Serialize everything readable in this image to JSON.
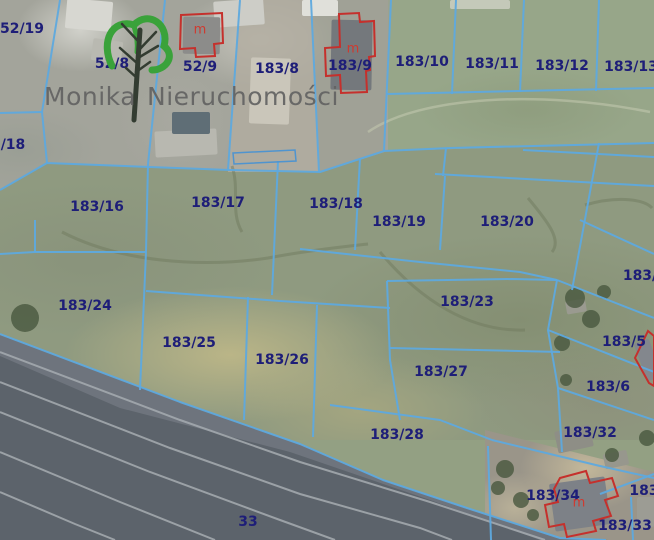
{
  "logo": {
    "word1": "Monika",
    "word2": "Nieruchomości"
  },
  "map": {
    "colors": {
      "boundary": "#5ea9de",
      "building_outline": "#c5302c",
      "label": "#1e1e78",
      "label_red": "#cf3a30",
      "railway_fill": "#5c636b",
      "railway_inner": "#7d848c",
      "railway_stripe": "#a6abb0",
      "track_dark": "#6f7a5e",
      "track_light": "#c5cbb0",
      "tree_fill": "#48583f",
      "shed_outline": "#4f94cf"
    },
    "parcel_labels": [
      {
        "text": "52/19",
        "x": 22,
        "y": 29
      },
      {
        "text": "52/8",
        "x": 112,
        "y": 64
      },
      {
        "text": "52/9",
        "x": 200,
        "y": 67
      },
      {
        "text": "183/8",
        "x": 277,
        "y": 69
      },
      {
        "text": "183/9",
        "x": 350,
        "y": 66
      },
      {
        "text": "183/10",
        "x": 422,
        "y": 62
      },
      {
        "text": "183/11",
        "x": 492,
        "y": 64
      },
      {
        "text": "183/12",
        "x": 562,
        "y": 66
      },
      {
        "text": "183/13",
        "x": 631,
        "y": 67
      },
      {
        "text": "/18",
        "x": 13,
        "y": 145
      },
      {
        "text": "183/16",
        "x": 97,
        "y": 207
      },
      {
        "text": "183/17",
        "x": 218,
        "y": 203
      },
      {
        "text": "183/18",
        "x": 336,
        "y": 204
      },
      {
        "text": "183/19",
        "x": 399,
        "y": 222
      },
      {
        "text": "183/20",
        "x": 507,
        "y": 222
      },
      {
        "text": "183/",
        "x": 640,
        "y": 276
      },
      {
        "text": "183/24",
        "x": 85,
        "y": 306
      },
      {
        "text": "183/23",
        "x": 467,
        "y": 302
      },
      {
        "text": "183/25",
        "x": 189,
        "y": 343
      },
      {
        "text": "183/26",
        "x": 282,
        "y": 360
      },
      {
        "text": "183/5",
        "x": 624,
        "y": 342
      },
      {
        "text": "183/27",
        "x": 441,
        "y": 372
      },
      {
        "text": "183/6",
        "x": 608,
        "y": 387
      },
      {
        "text": "183/32",
        "x": 590,
        "y": 433
      },
      {
        "text": "183/28",
        "x": 397,
        "y": 435
      },
      {
        "text": "183/34",
        "x": 553,
        "y": 496
      },
      {
        "text": "183",
        "x": 644,
        "y": 491
      },
      {
        "text": "183/33",
        "x": 625,
        "y": 526
      },
      {
        "text": "33",
        "x": 248,
        "y": 522
      }
    ],
    "building_marks": [
      {
        "text": "m",
        "x": 200,
        "y": 30
      },
      {
        "text": "m",
        "x": 353,
        "y": 49
      },
      {
        "text": "m",
        "x": 579,
        "y": 503
      }
    ],
    "buildings": [
      {
        "id": "building-52-9",
        "points": "181,15 222,13 223,43 214,44 215,56 196,57 195,48 180,49"
      },
      {
        "id": "building-183-9",
        "points": "339,14 359,13 360,22 374,21 375,56 369,57 370,70 366,71 367,92 341,93 340,75 326,76 325,48 340,47"
      },
      {
        "id": "building-183-5",
        "points": "648,331 654,336 654,386 649,383 635,358"
      },
      {
        "id": "building-183-34",
        "points": "560,478 586,471 590,483 612,478 618,496 605,500 611,516 593,521 596,531 567,537 564,524 549,527 545,505 558,502 554,489"
      }
    ],
    "shed_outline": "233,153 295,150 296,161 234,164",
    "boundary_lines": [
      "60,0 42,112",
      "165,0 148,164",
      "240,0 228,170",
      "311,0 319,172",
      "391,0 384,151",
      "456,0 452,94",
      "524,0 520,92",
      "599,0 596,91",
      "0,113 42,112",
      "42,112 47,163",
      "0,190 47,163 150,167 230,170 320,172 384,151",
      "384,151 450,148 654,143",
      "387,94 654,88",
      "523,150 654,157",
      "435,174 654,186",
      "446,148 443,176",
      "148,164 146,252 140,390",
      "278,161 272,295",
      "360,158 355,250",
      "445,176 440,250",
      "599,143 572,290",
      "300,249 420,262 520,272 557,280",
      "387,281 512,279 557,280",
      "35,220 35,252",
      "0,254 35,252 146,252",
      "146,291 280,301 390,308",
      "248,297 244,420",
      "317,305 313,437",
      "387,281 390,360 400,420",
      "390,348 560,352",
      "580,220 654,254",
      "557,280 654,318",
      "548,330 654,372",
      "558,388 654,420",
      "557,280 548,330 558,388 562,452",
      "330,405 440,420 492,440",
      "492,440 600,466 654,478",
      "600,494 654,474",
      "488,446 491,540",
      "631,497 633,540",
      "0,334 180,402 300,444 383,480 467,508 560,538 606,540"
    ],
    "railway": {
      "area": "0,334 180,402 300,444 383,480 467,508 560,538 608,540 0,540",
      "inner": "0,334 180,402 300,444 383,480 467,508 560,538 600,540 540,540 430,500 290,452 120,408 0,356",
      "stripes": [
        "0,352 180,420 300,462 430,502 545,540",
        "0,382 170,448 300,494 420,528 452,540",
        "0,412 150,472 280,520 335,540",
        "0,452 120,502 215,540",
        "0,492 75,524 115,540"
      ]
    },
    "tracks_dark": [
      "M62,232 C120,262 200,268 268,258 C310,250 350,246 368,244",
      "M380,252 C420,300 470,332 525,330",
      "M528,198 C548,222 562,240 552,252",
      "M232,166 C240,190 230,212 242,232",
      "M585,205 C620,195 645,200 652,208"
    ],
    "tracks_light": [
      "M368,132 C420,96 540,90 650,112"
    ],
    "trees": [
      [
        575,
        298,
        10
      ],
      [
        591,
        319,
        9
      ],
      [
        562,
        343,
        8
      ],
      [
        604,
        292,
        7
      ],
      [
        505,
        469,
        9
      ],
      [
        521,
        500,
        8
      ],
      [
        612,
        455,
        7
      ],
      [
        647,
        438,
        8
      ],
      [
        566,
        380,
        6
      ],
      [
        498,
        488,
        7
      ],
      [
        533,
        515,
        6
      ],
      [
        25,
        318,
        14
      ]
    ],
    "terrain": {
      "driveway": "240,0 312,0 320,172 228,172",
      "yard_183_9": "312,0 391,0 384,151 320,172",
      "patches": [
        {
          "x": 66,
          "y": 0,
          "w": 46,
          "h": 30,
          "r": 5,
          "c": "#d7d7d1"
        },
        {
          "x": 214,
          "y": 0,
          "w": 50,
          "h": 26,
          "r": -4,
          "c": "#cdcdc7"
        },
        {
          "x": 302,
          "y": 0,
          "w": 36,
          "h": 16,
          "r": 0,
          "c": "#e0e0da"
        },
        {
          "x": 155,
          "y": 130,
          "w": 62,
          "h": 26,
          "r": -3,
          "c": "#b8b8b0"
        },
        {
          "x": 250,
          "y": 58,
          "w": 40,
          "h": 66,
          "r": 2,
          "c": "#cac6ba"
        },
        {
          "x": 172,
          "y": 112,
          "w": 38,
          "h": 22,
          "r": 0,
          "c": "#5f6e76"
        },
        {
          "x": 183,
          "y": 17,
          "w": 37,
          "h": 37,
          "r": 1,
          "c": "#8c8c8a"
        },
        {
          "x": 331,
          "y": 20,
          "w": 41,
          "h": 70,
          "r": 1,
          "c": "#74787c"
        },
        {
          "x": 92,
          "y": 40,
          "w": 30,
          "h": 22,
          "r": 8,
          "c": "#b9b9b1"
        },
        {
          "x": 450,
          "y": 0,
          "w": 60,
          "h": 9,
          "r": 0,
          "c": "#c4c9b9"
        },
        {
          "x": 556,
          "y": 428,
          "w": 36,
          "h": 22,
          "r": -12,
          "c": "#8e8e86"
        },
        {
          "x": 604,
          "y": 452,
          "w": 24,
          "h": 15,
          "r": -12,
          "c": "#97978d"
        },
        {
          "x": 637,
          "y": 497,
          "w": 17,
          "h": 30,
          "r": 0,
          "c": "#9c9c94"
        },
        {
          "x": 552,
          "y": 480,
          "w": 56,
          "h": 48,
          "r": -8,
          "c": "#7d8187"
        },
        {
          "x": 566,
          "y": 300,
          "w": 20,
          "h": 13,
          "r": -10,
          "c": "#9a9a90"
        },
        {
          "x": 640,
          "y": 340,
          "w": 16,
          "h": 40,
          "r": -20,
          "c": "#83878d"
        }
      ]
    }
  }
}
